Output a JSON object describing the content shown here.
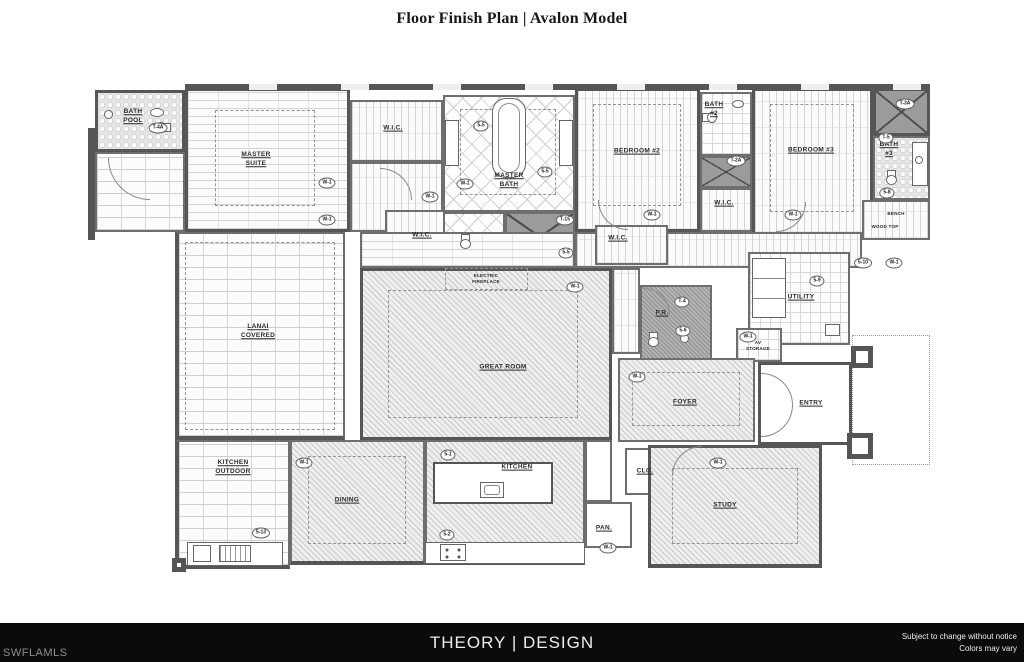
{
  "title": "Floor Finish Plan | Avalon Model",
  "colors": {
    "wall": "#565656",
    "footer-bg": "#0b0b0b",
    "footer-text": "#ededed",
    "footer-muted": "#8f8f8f"
  },
  "plan": {
    "rooms": {
      "pool_bath": "BATH\nPOOL",
      "master_suite": "MASTER\nSUITE",
      "wic_master_1": "W.I.C.",
      "wic_master_2": "W.I.C.",
      "master_bath": "MASTER\nBATH",
      "bedroom_2": "BEDROOM #2",
      "bath_2": "BATH\n#2",
      "wic_bedroom_2": "W.I.C.",
      "bedroom_3": "BEDROOM #3",
      "bath_3": "BATH\n#3",
      "wic_bedroom_3": "W.I.C.",
      "bench": "BENCH",
      "wood_top": "WOOD TOP",
      "electric_fireplace": "ELECTRIC\nFIREPLACE",
      "great_room": "GREAT ROOM",
      "lanai": "LANAI\nCOVERED",
      "powder_room": "P.R.",
      "utility": "UTILITY",
      "av_storage": "AV\nSTORAGE",
      "foyer": "FOYER",
      "entry": "ENTRY",
      "outdoor_kitchen": "KITCHEN\nOUTDOOR",
      "dining": "DINING",
      "kitchen": "KITCHEN",
      "closet": "CLO.",
      "pantry": "PAN.",
      "study": "STUDY"
    },
    "finish_tags": [
      {
        "code": "T-4A",
        "x": 70,
        "y": 44
      },
      {
        "code": "W-1",
        "x": 239,
        "y": 99
      },
      {
        "code": "W-1",
        "x": 239,
        "y": 136
      },
      {
        "code": "5-5",
        "x": 393,
        "y": 42
      },
      {
        "code": "5-5",
        "x": 457,
        "y": 88
      },
      {
        "code": "W-1",
        "x": 342,
        "y": 113
      },
      {
        "code": "W-1",
        "x": 377,
        "y": 100
      },
      {
        "code": "T-15",
        "x": 477,
        "y": 136
      },
      {
        "code": "5-5",
        "x": 478,
        "y": 169
      },
      {
        "code": "W-1",
        "x": 564,
        "y": 131
      },
      {
        "code": "T-2A",
        "x": 648,
        "y": 77
      },
      {
        "code": "W-1",
        "x": 705,
        "y": 131
      },
      {
        "code": "T-3A",
        "x": 817,
        "y": 20
      },
      {
        "code": "T-5",
        "x": 798,
        "y": 54
      },
      {
        "code": "5-8",
        "x": 799,
        "y": 109
      },
      {
        "code": "5-10",
        "x": 775,
        "y": 179
      },
      {
        "code": "W-1",
        "x": 806,
        "y": 179
      },
      {
        "code": "W-1",
        "x": 487,
        "y": 203
      },
      {
        "code": "T-4",
        "x": 594,
        "y": 218
      },
      {
        "code": "5-6",
        "x": 595,
        "y": 247
      },
      {
        "code": "5-9",
        "x": 729,
        "y": 197
      },
      {
        "code": "W-1",
        "x": 660,
        "y": 253
      },
      {
        "code": "W-1",
        "x": 549,
        "y": 293
      },
      {
        "code": "5-1",
        "x": 360,
        "y": 371
      },
      {
        "code": "W-1",
        "x": 216,
        "y": 379
      },
      {
        "code": "5-2",
        "x": 359,
        "y": 451
      },
      {
        "code": "5-13",
        "x": 173,
        "y": 449
      },
      {
        "code": "W-1",
        "x": 520,
        "y": 464
      },
      {
        "code": "W-1",
        "x": 630,
        "y": 379
      }
    ]
  },
  "footer": {
    "left": "SWFLAMLS",
    "center": "THEORY | DESIGN",
    "right_line1": "Subject to change without notice",
    "right_line2": "Colors may vary"
  }
}
